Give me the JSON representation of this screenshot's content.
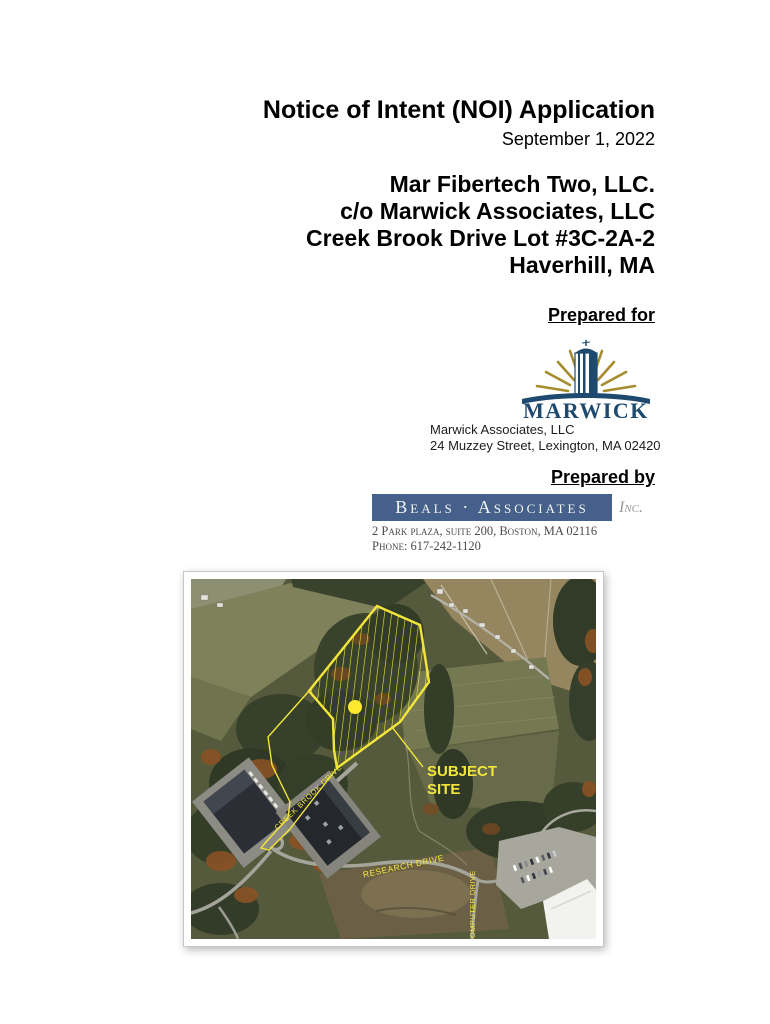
{
  "doc": {
    "title": "Notice of Intent (NOI) Application",
    "date": "September 1, 2022",
    "applicant_lines": {
      "0": "Mar Fibertech Two, LLC.",
      "1": "c/o Marwick Associates, LLC",
      "2": "Creek Brook Drive Lot #3C-2A-2",
      "3": "Haverhill, MA"
    },
    "prepared_for": {
      "heading": "Prepared for",
      "logo_text": "MARWICK",
      "company": "Marwick Associates, LLC",
      "address": "24 Muzzey Street, Lexington, MA 02420"
    },
    "prepared_by": {
      "heading": "Prepared by",
      "logo_text": "Beals · Associates",
      "logo_suffix": "Inc.",
      "address": "2 Park plaza, suite 200, Boston, MA 02116",
      "phone": "Phone: 617-242-1120"
    }
  },
  "map": {
    "subject_site_line1": "SUBJECT",
    "subject_site_line2": "SITE",
    "road_creek_brook": "CREEK BROOK DRIVE",
    "road_research": "RESEARCH DRIVE",
    "road_computer": "COMPUTER DRIVE"
  },
  "colors": {
    "logo_navy": "#1d4a6e",
    "logo_gold": "#a68c2d",
    "beals_bar_blue": "#45608a",
    "map_overlay_yellow": "#f2e63b",
    "site_marker_yellow": "#ffe92e"
  }
}
